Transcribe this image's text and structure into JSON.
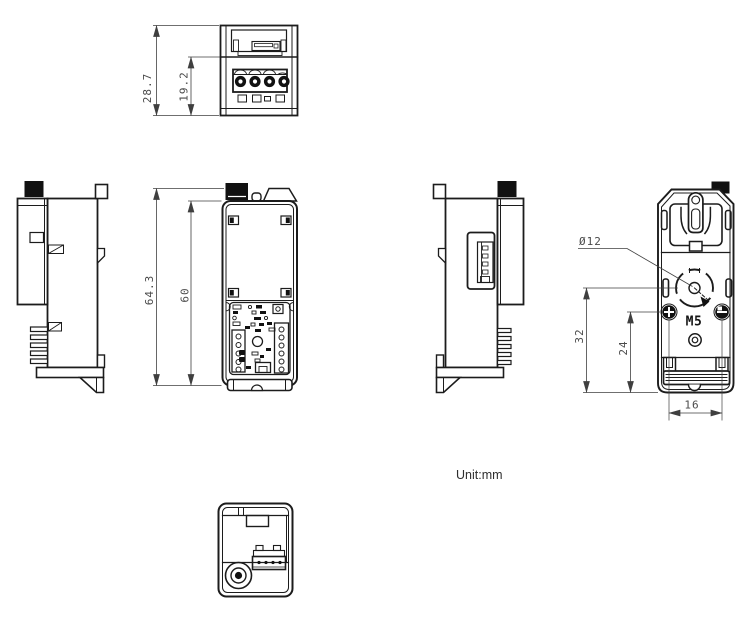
{
  "note": {
    "unit_label": "Unit:mm"
  },
  "dimension_labels": {
    "top_overall": "28.7",
    "top_terminal": "19.2",
    "front_overall": "64.3",
    "front_body": "60",
    "rear_hole_diameter": "Ø12",
    "rear_hole_to_bottom": "32",
    "rear_screws_to_bottom": "24",
    "rear_screw_spacing": "16",
    "rear_thread": "M5"
  },
  "colors": {
    "background": "#ffffff",
    "outline": "#1c1c1c",
    "dark_fill": "#111111",
    "dimension_line": "#3f3f3f",
    "dimension_text": "#4a4a4a"
  }
}
